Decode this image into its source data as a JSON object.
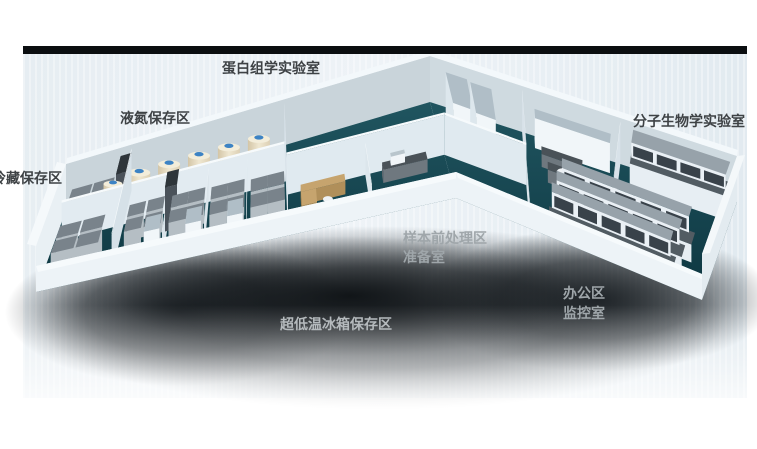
{
  "labels": {
    "proteomics_lab": "蛋白组学实验室",
    "liquid_nitrogen_area": "液氮保存区",
    "cold_storage_area": "冷藏保存区",
    "molecular_biology_lab": "分子生物学实验室",
    "sample_pretreatment_area": "样本前处理区",
    "prep_room": "准备室",
    "office_area": "办公区",
    "monitoring_room": "监控室",
    "ult_freezer_area": "超低温冰箱保存区"
  },
  "colors": {
    "floor_teal": "#14444f",
    "wall_white": "#eef4f8",
    "tank_body_cream": "#e8ddc2",
    "tank_cap_blue": "#3d83c4",
    "freezer_gray": "#9aa4ab",
    "label_dark": "#3e4245",
    "label_light": "#b5babd",
    "top_bar_black": "#0b0e10",
    "backdrop_blue_gray": "#e6edf2"
  }
}
